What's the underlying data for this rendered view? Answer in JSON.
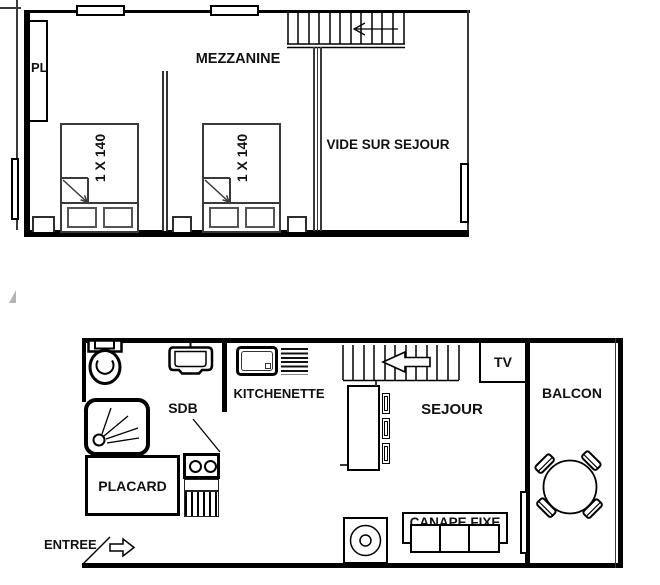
{
  "floor_plan": {
    "upper_floor": {
      "name_label": "MEZZANINE",
      "closet_label": "PL",
      "void_label": "VIDE SUR SEJOUR",
      "bed1_label": "1 X 140",
      "bed2_label": "1 X 140"
    },
    "lower_floor": {
      "kitchenette_label": "KITCHENETTE",
      "bathroom_label": "SDB",
      "closet_label": "PLACARD",
      "entrance_label": "ENTREE",
      "living_room_label": "SEJOUR",
      "tv_label": "TV",
      "balcony_label": "BALCON",
      "sofa_label": "CANAPE FIXE"
    },
    "colors": {
      "line": "#000000",
      "background": "#ffffff"
    }
  }
}
